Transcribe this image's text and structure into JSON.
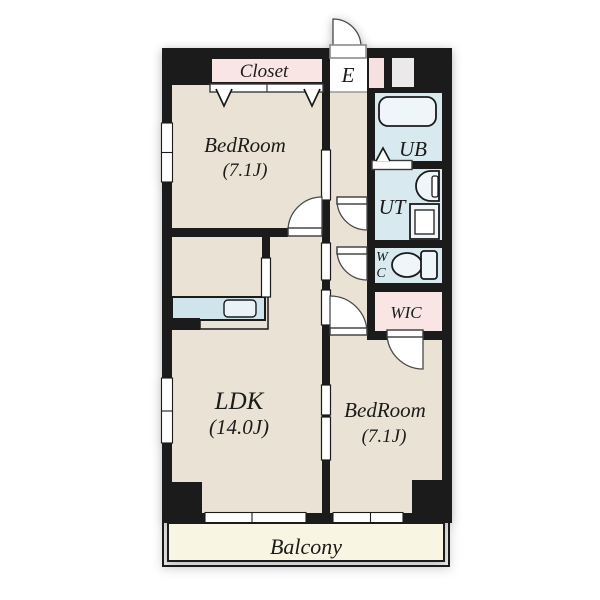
{
  "title": "Apartment floor plan",
  "colors": {
    "wall": "#1b1b1b",
    "room": "#eae2d4",
    "pink": "#f8e5e4",
    "blue": "#d8e9ef",
    "fixture": "#eff6f9",
    "counter": "#cfe4eb",
    "balcony": "#f8f5e2",
    "pink_box": "#f6e0e0",
    "gray_box": "#ebe9e9",
    "text": "#1b1b1b"
  },
  "rooms": {
    "closet": {
      "label": "Closet"
    },
    "entrance": {
      "label": "E"
    },
    "bedroom1": {
      "label": "BedRoom",
      "size": "(7.1J)"
    },
    "unit_bath": {
      "label": "UB"
    },
    "utility": {
      "label": "UT"
    },
    "wc": {
      "label_line1": "W",
      "label_line2": "C"
    },
    "walk_in_closet": {
      "label": "WIC"
    },
    "ldk": {
      "label": "LDK",
      "size": "(14.0J)"
    },
    "bedroom2": {
      "label": "BedRoom",
      "size": "(7.1J)"
    },
    "balcony": {
      "label": "Balcony"
    }
  },
  "fixtures": [
    "bathtub-icon",
    "washbasin-icon",
    "washing-machine-icon",
    "toilet-icon",
    "kitchen-counter-icon",
    "kitchen-sink-icon",
    "shoe-box-icon",
    "meter-box-icon"
  ]
}
